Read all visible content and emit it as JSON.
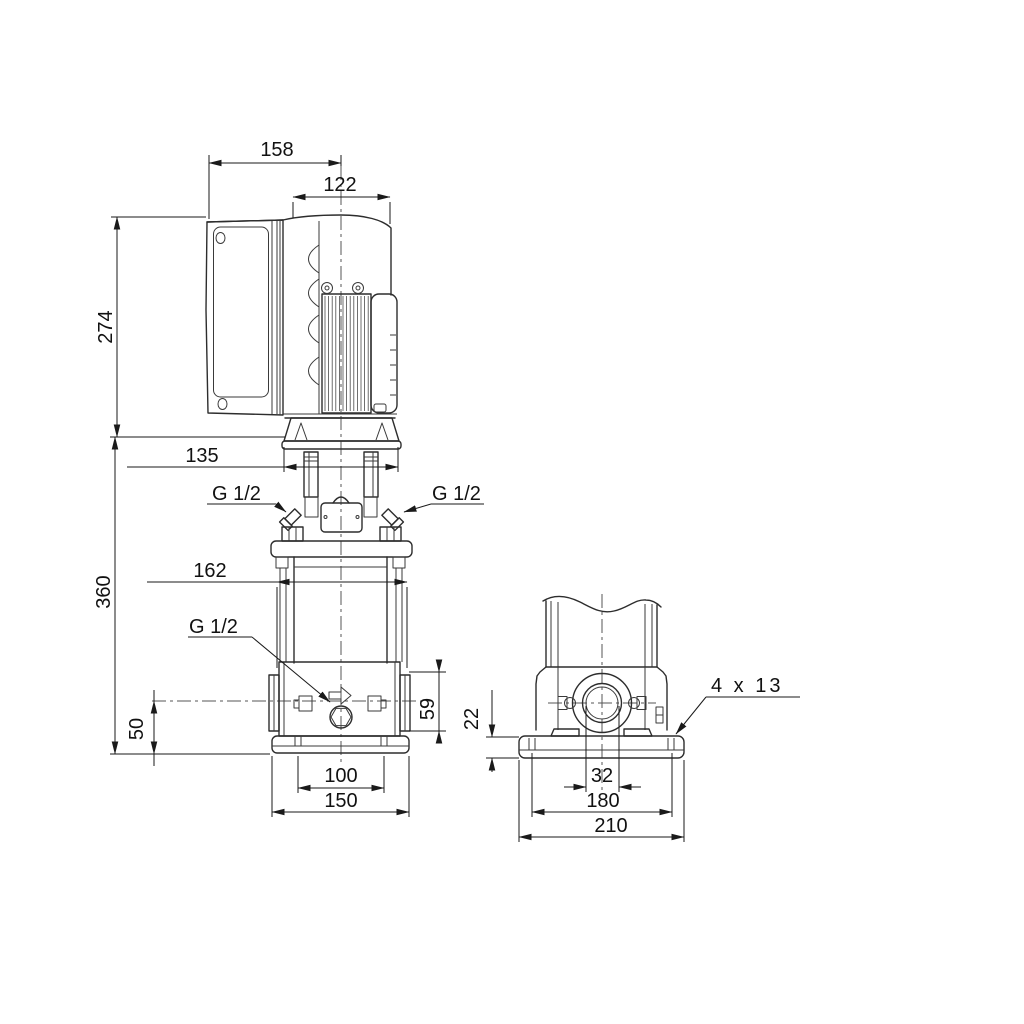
{
  "drawing": {
    "type": "pump dimensional drawing, two orthographic views",
    "colors": {
      "line": "#2d2d2d",
      "dimension": "#1a1a1a",
      "background": "#ffffff"
    },
    "front": {
      "overall_width": "158",
      "motor_width": "122",
      "motor_height": "274",
      "flange_width": "135",
      "sleeve_width": "162",
      "pump_height": "360",
      "port_center_to_base": "50",
      "port_flange_height": "59",
      "base_holes_width": "100",
      "base_width": "150",
      "vent_port_left": "G 1/2",
      "vent_port_right": "G 1/2",
      "drain_port": "G 1/2"
    },
    "side": {
      "base_height": "22",
      "port_bore": "32",
      "base_holes_length": "180",
      "base_length": "210",
      "foundation_holes": "4 x 13"
    }
  }
}
